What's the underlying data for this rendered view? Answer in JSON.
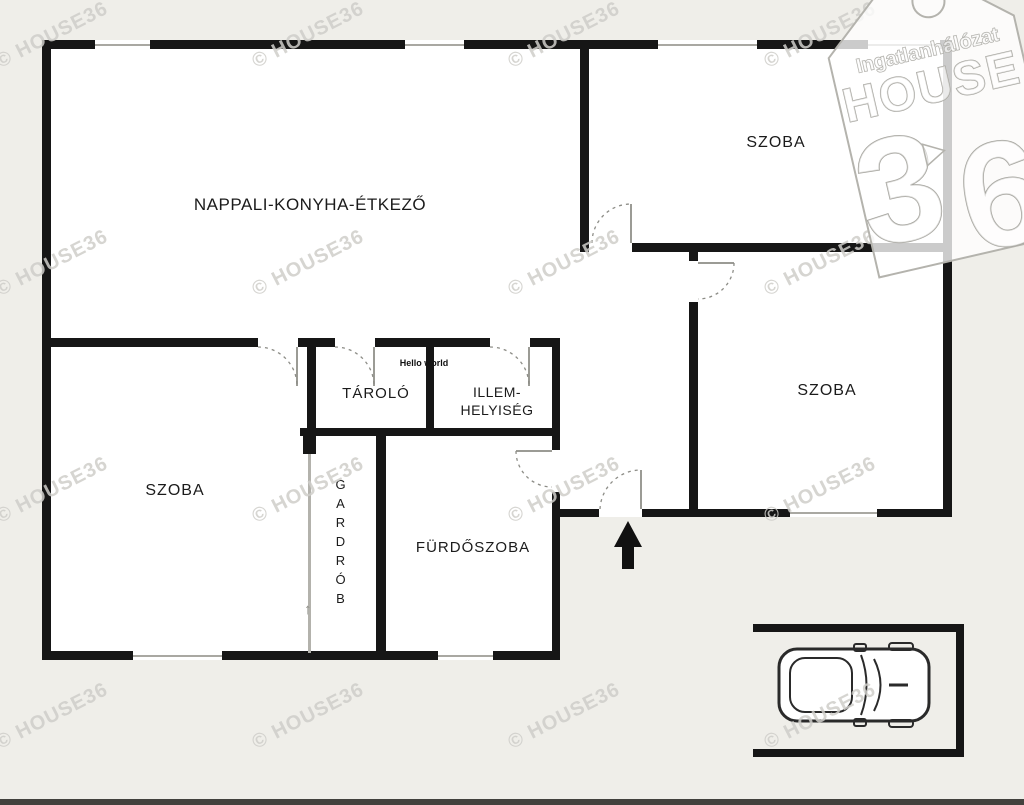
{
  "rooms": {
    "nappali": {
      "label": "NAPPALI-KONYHA-ÉTKEZŐ"
    },
    "szoba_top": {
      "label": "SZOBA"
    },
    "szoba_right": {
      "label": "SZOBA"
    },
    "szoba_left": {
      "label": "SZOBA"
    },
    "tarolo": {
      "label": "TÁROLÓ"
    },
    "illem": {
      "line1": "ILLEM-",
      "line2": "HELYISÉG"
    },
    "gardrob": {
      "label": "GARDRÓB"
    },
    "furdoszoba": {
      "label": "FÜRDŐSZOBA"
    }
  },
  "annotations": {
    "hello_text": "Hello world",
    "gardrob_arrow": "↑"
  },
  "watermark": {
    "text": "© HOUSE36"
  },
  "logo": {
    "brand_top": "Ingatlanhálózat",
    "brand_main": "HOUSE",
    "digit_left": "3",
    "digit_right": "6"
  },
  "colors": {
    "wall": "#161616",
    "background": "#efeee9",
    "floor": "#ffffff",
    "thin_line": "#a9a8a2",
    "watermark": "#cfceca"
  }
}
